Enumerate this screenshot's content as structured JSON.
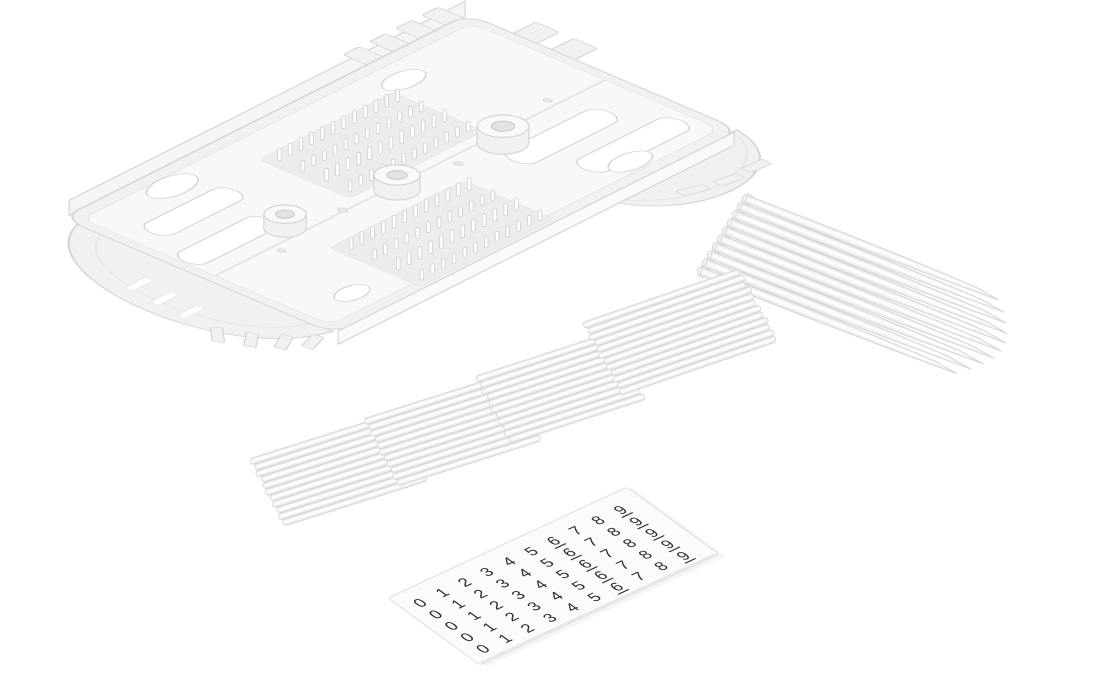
{
  "scene": {
    "type": "product-photo",
    "subject": "Fiber optic splice tray kit: splice cassette, splice protection sleeve bundles, flexible strip comb, number label sheet",
    "background_color": "#ffffff",
    "width_px": 1096,
    "height_px": 700
  },
  "parts": {
    "splice_tray": {
      "label": "splice-tray",
      "body_color": "#f1f1f1",
      "floor_color": "#f8f8f8",
      "comb_fields": 2,
      "comb_rows": 4,
      "comb_cols": 12,
      "post_count": 3,
      "far_tab_count": 4,
      "side_tab_count": 2,
      "slot_count": 4
    },
    "strip_comb": {
      "label": "flexible-strip-comb",
      "strip_count": 10,
      "color": "#f5f5f5"
    },
    "sleeve_bundles": {
      "label": "splice-protection-sleeves",
      "bundle_count": 4,
      "tubes_per_bundle": [
        11,
        11,
        11,
        12
      ],
      "color": "#eeeeee"
    },
    "number_sheet": {
      "label": "number-label-sheet",
      "digits": [
        "0",
        "1",
        "2",
        "3",
        "4",
        "5",
        "6",
        "7",
        "8",
        "9"
      ],
      "copies_per_digit": 5,
      "underlined_digits": [
        "6",
        "9"
      ],
      "digit_color": "#2d2d2d",
      "sheet_color": "#fbfbfb"
    }
  },
  "palette": {
    "outline": "#d5d5d5",
    "soft_outline": "#e4e4e4",
    "tube_stroke": "#d7d7d7",
    "field_fill": "#ececec",
    "hole_fill": "#e6e6e6",
    "highlight": "#ffffff",
    "wall_fill": "#f5f5f5",
    "sheet_edge": "#dfdfdf"
  }
}
